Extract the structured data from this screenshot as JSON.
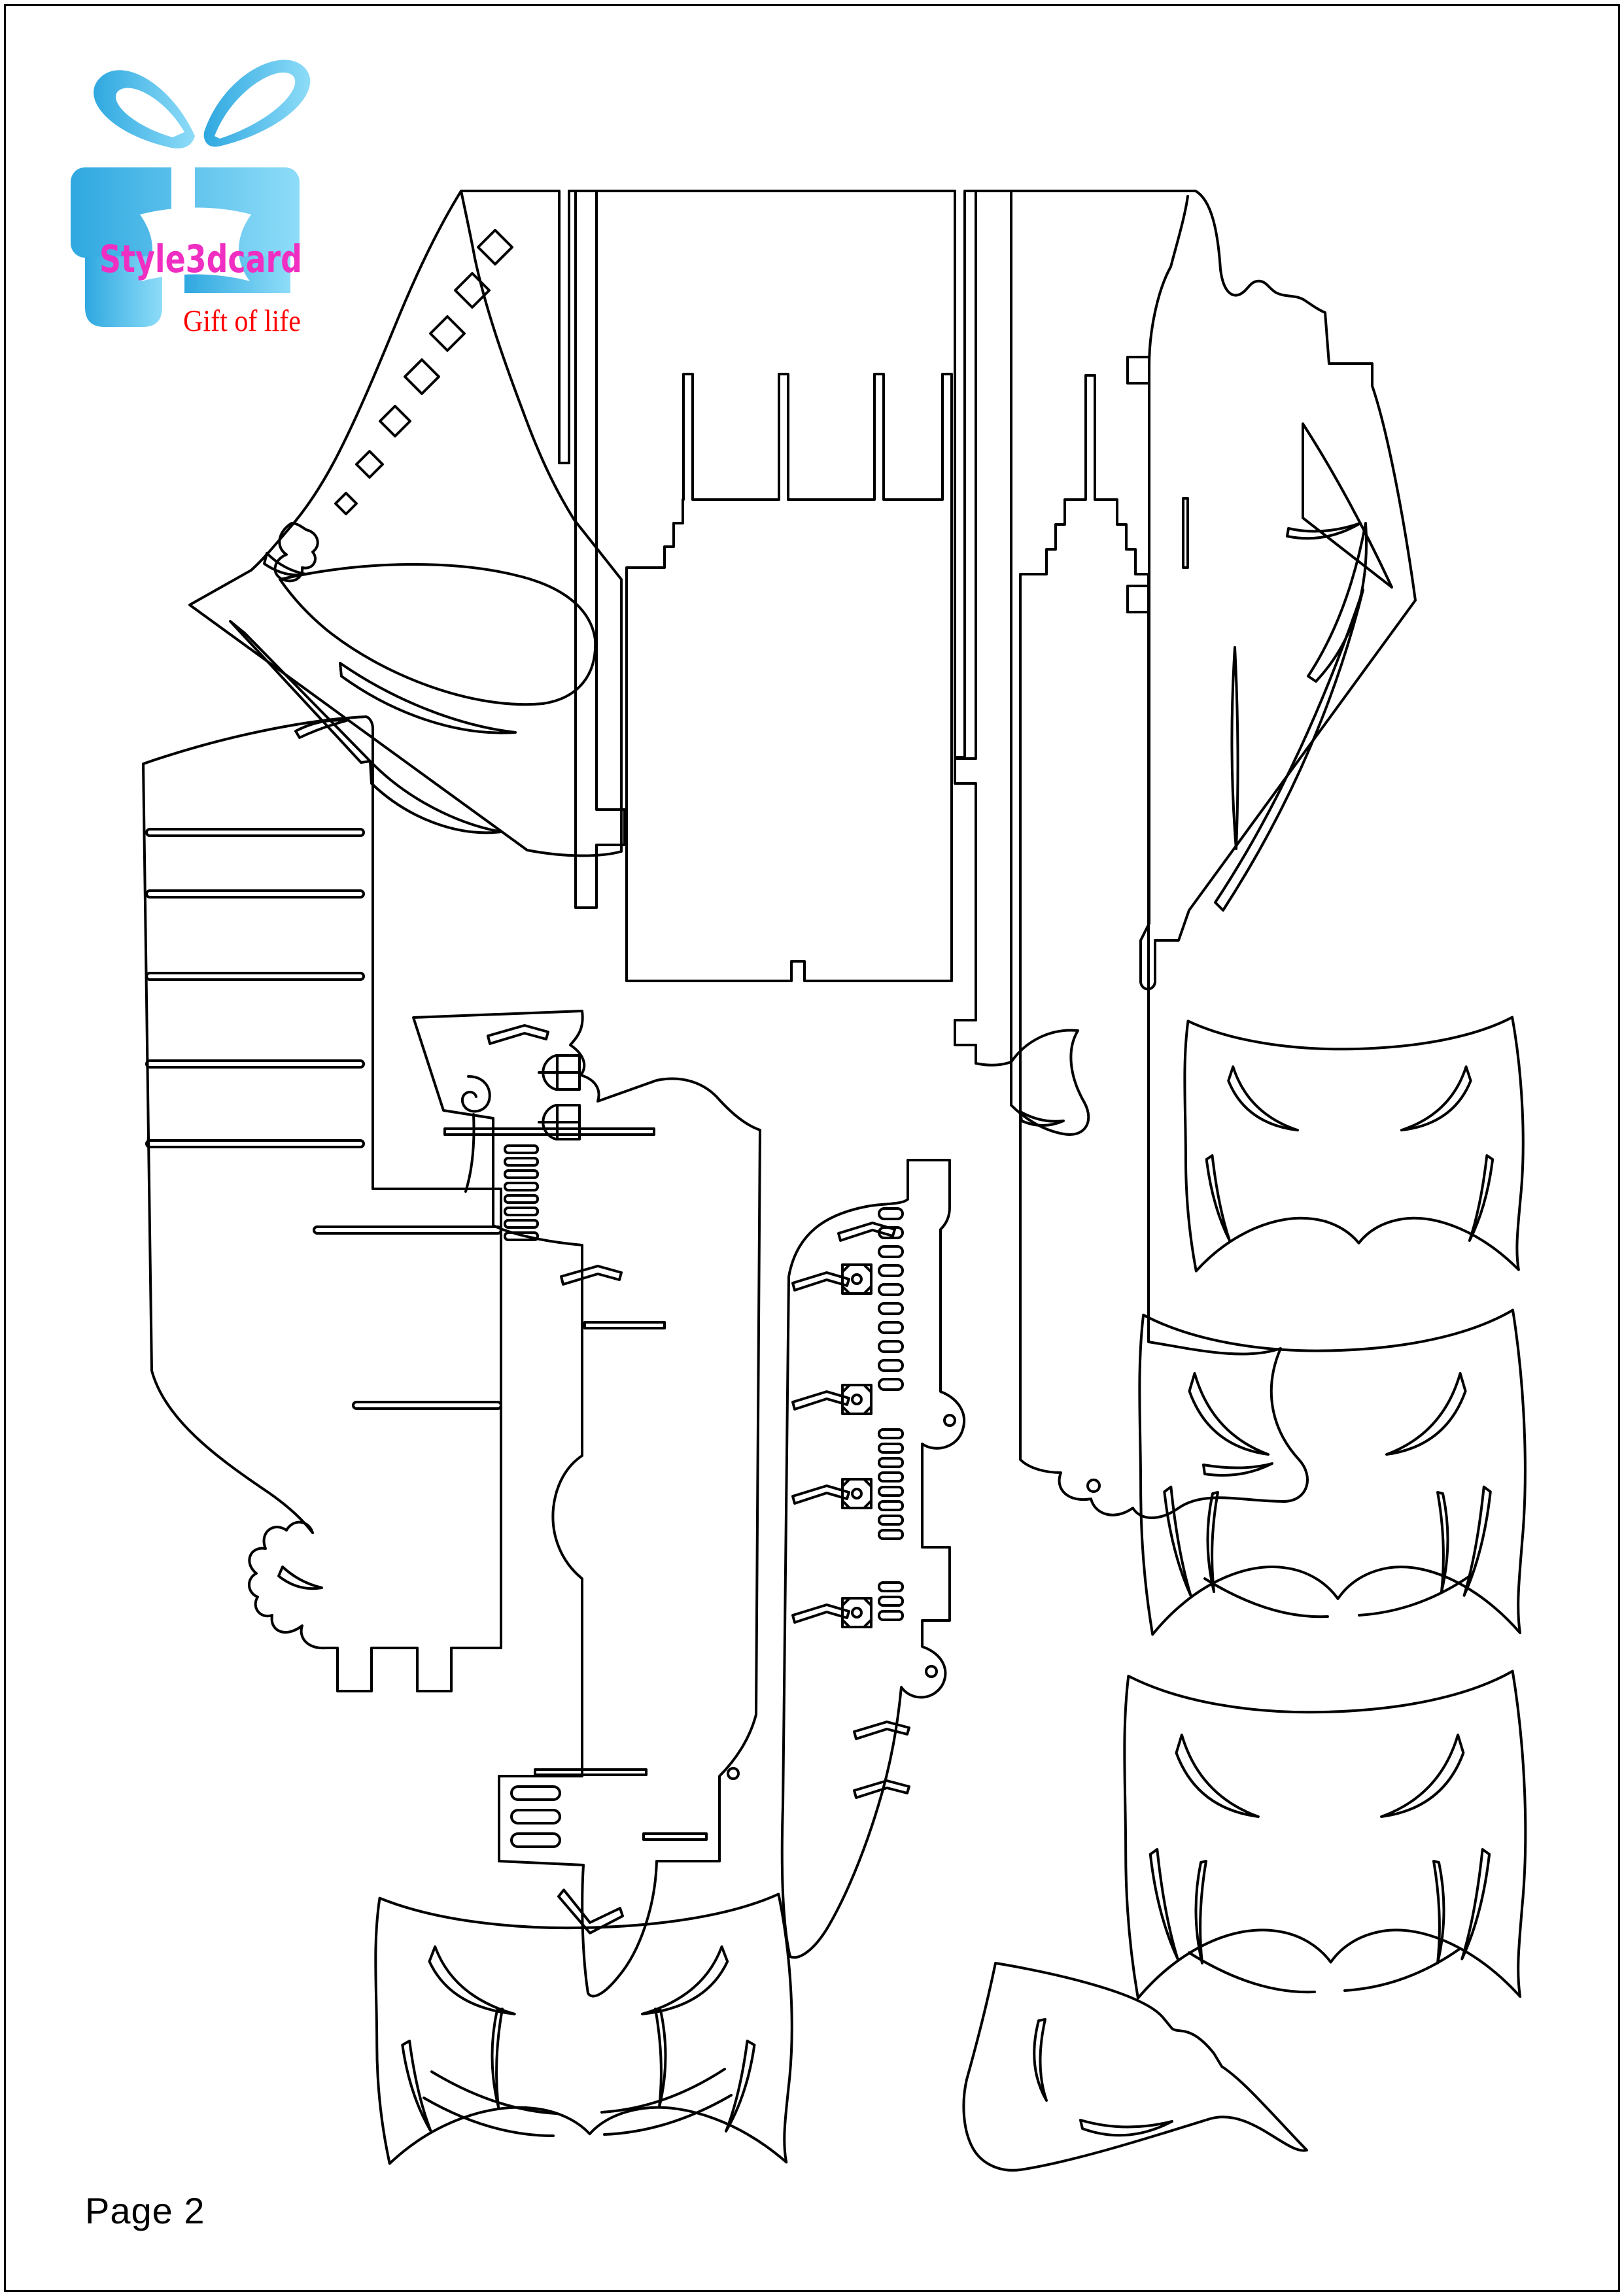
{
  "page": {
    "label": "Page 2"
  },
  "logo": {
    "brand": "Style3dcard",
    "tagline": "Gift of life",
    "gift_box_icon": "gift-box-with-ribbon-bow"
  },
  "colors": {
    "outline": "#000000",
    "paper": "#ffffff",
    "brand_text": "#f02fc2",
    "tagline_text": "#ff0000",
    "box_blue": "#2fa8e0",
    "box_blue_light": "#8edcf8",
    "page_text": "#000000"
  },
  "pattern": {
    "kind": "papercraft cutting template (pop-up card pattern sheet)",
    "pieces": [
      {
        "id": "deck-frame",
        "label": "Deck frame with long cut slits and starboard block"
      },
      {
        "id": "bow-band-port",
        "label": "Port bow band with diamond porthole cutouts"
      },
      {
        "id": "bow-triangle-port",
        "label": "Port triangle panel with curved openings"
      },
      {
        "id": "bow-triangle-starboard",
        "label": "Starboard triangle panel with crescent slits"
      },
      {
        "id": "mast-strip",
        "label": "Hanging mast strip with side tab"
      },
      {
        "id": "deck-comb-left",
        "label": "Left deck comb with crown prongs"
      },
      {
        "id": "deck-comb-right",
        "label": "Right deck comb with wavy banner end"
      },
      {
        "id": "spine-strip",
        "label": "Spine strip with tabs and banner flourish"
      },
      {
        "id": "side-plate",
        "label": "Stepped side plate with slot comb and castle tabs"
      },
      {
        "id": "superstructure",
        "label": "Superstructure panel with windows, spiral and slot ladder"
      },
      {
        "id": "keel-spine",
        "label": "Keel spine with oval slot columns, rosette squares and chevrons"
      },
      {
        "id": "hull-panel-1",
        "label": "Hull side panel with crescent score lines"
      },
      {
        "id": "hull-panel-2",
        "label": "Hull side panel with crescent and smile score lines"
      },
      {
        "id": "hull-panel-3",
        "label": "Hull side panel with crescent and smile score lines"
      },
      {
        "id": "hull-panel-4",
        "label": "Hull side panel with triple smile score lines"
      },
      {
        "id": "stern-sail",
        "label": "Stern sail triangle with crescent slits"
      }
    ]
  }
}
